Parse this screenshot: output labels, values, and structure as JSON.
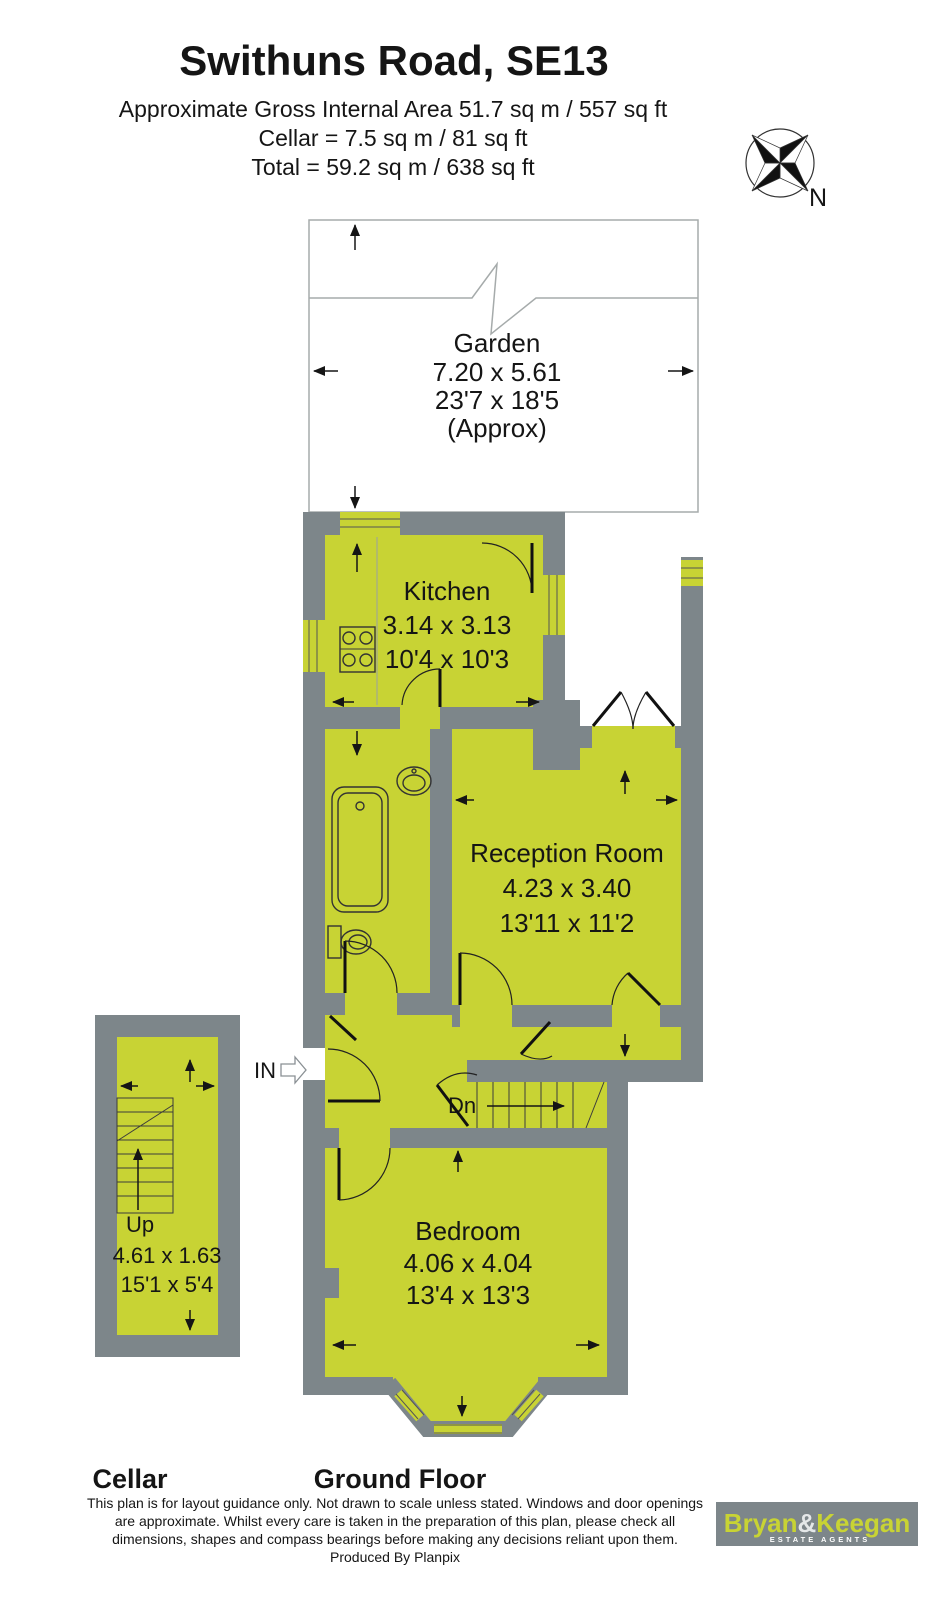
{
  "header": {
    "title": "Swithuns Road, SE13",
    "line1": "Approximate Gross Internal Area  51.7 sq m / 557 sq ft",
    "line2": "Cellar  =  7.5 sq m / 81 sq ft",
    "line3": "Total = 59.2 sq m / 638 sq ft"
  },
  "compass": {
    "north": "N"
  },
  "garden": {
    "name": "Garden",
    "metric": "7.20 x 5.61",
    "imperial": "23'7 x 18'5",
    "note": "(Approx)"
  },
  "rooms": {
    "kitchen": {
      "name": "Kitchen",
      "metric": "3.14 x 3.13",
      "imperial": "10'4 x 10'3"
    },
    "reception": {
      "name": "Reception Room",
      "metric": "4.23 x 3.40",
      "imperial": "13'11 x 11'2"
    },
    "bedroom": {
      "name": "Bedroom",
      "metric": "4.06 x 4.04",
      "imperial": "13'4 x 13'3"
    },
    "cellar": {
      "up_label": "Up",
      "metric": "4.61 x 1.63",
      "imperial": "15'1 x 5'4"
    }
  },
  "plan_labels": {
    "entrance": "IN",
    "stairs_down": "Dn"
  },
  "floor_labels": {
    "cellar": "Cellar",
    "ground": "Ground Floor"
  },
  "disclaimer": {
    "line1": "This plan is for layout guidance only. Not drawn to scale unless stated. Windows and door openings",
    "line2": "are approximate. Whilst every care is taken in the preparation of this plan, please check all",
    "line3": "dimensions, shapes and compass bearings before making any decisions reliant upon them.",
    "line4": "Produced By Planpix"
  },
  "logo": {
    "part1": "Bryan",
    "amp": "&",
    "part2": "Keegan",
    "tagline": "ESTATE AGENTS"
  },
  "colors": {
    "room_fill": "#c8d334",
    "wall": "#7d868a",
    "garden_outline": "#a6abab",
    "logo_bg": "#7d868a",
    "logo_text": "#c8d334"
  }
}
